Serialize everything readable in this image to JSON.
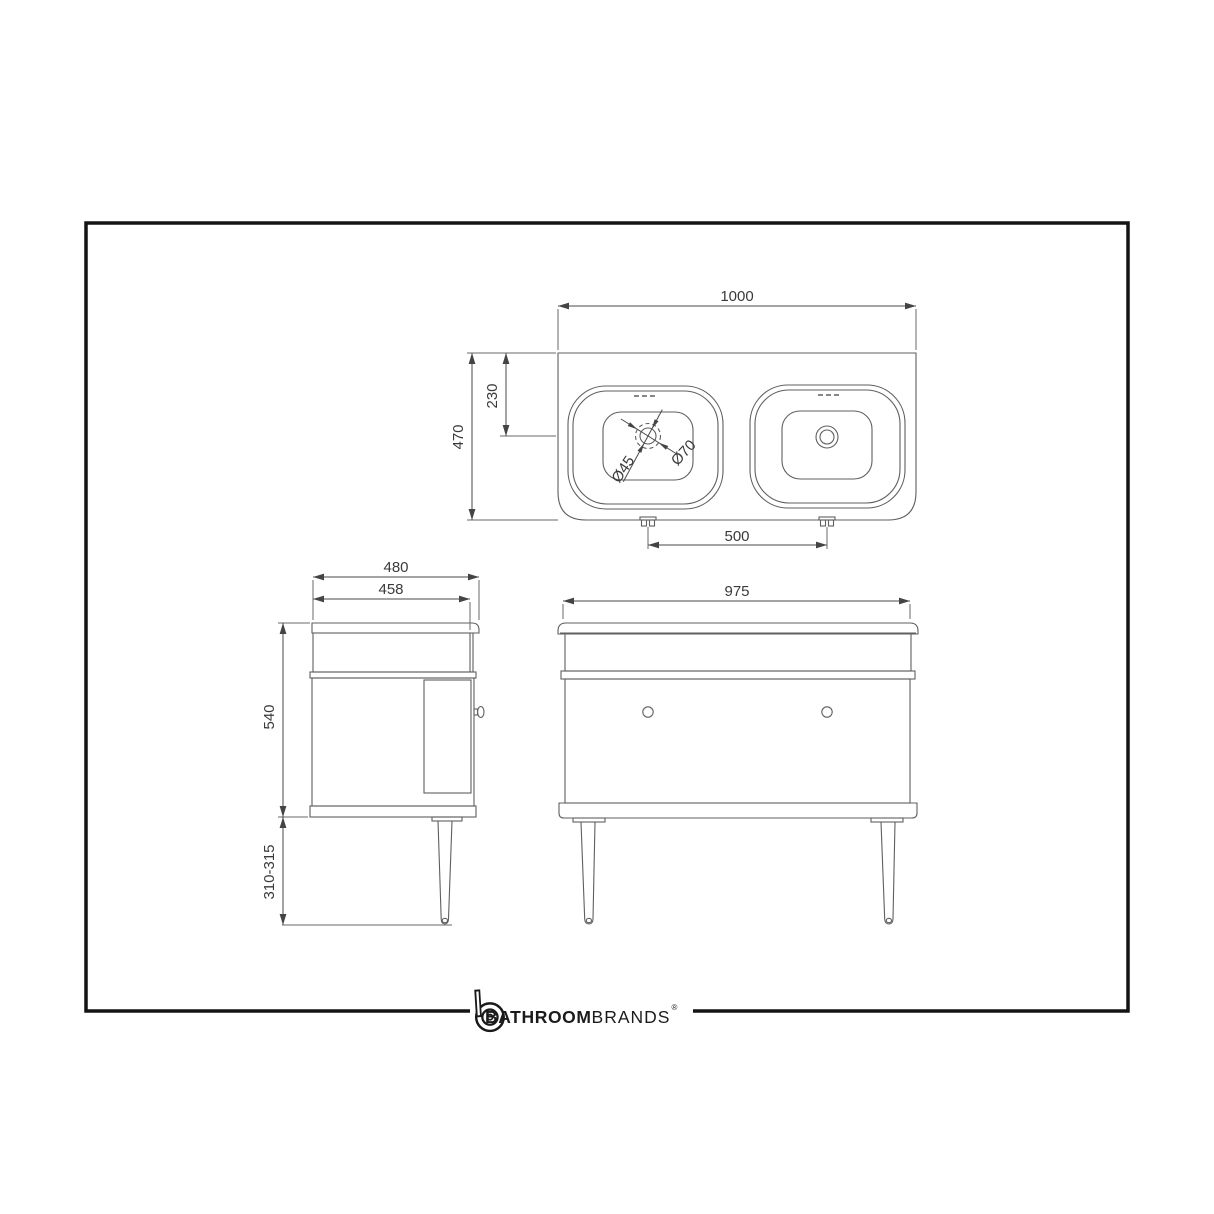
{
  "page": {
    "background": "#ffffff",
    "border_color": "#141414",
    "line_color": "#5f5f5f"
  },
  "views": {
    "top": {
      "title": "basin-plan-view",
      "dim_width": "1000",
      "dim_depth": "470",
      "dim_drain_setback": "230",
      "dim_waste_small": "Ø45",
      "dim_waste_large": "Ø70",
      "dim_fixing_centres": "500"
    },
    "side": {
      "title": "side-elevation",
      "dim_depth_overall": "480",
      "dim_depth_cabinet": "458",
      "dim_height_cabinet": "540",
      "dim_leg_height": "310-315"
    },
    "front": {
      "title": "front-elevation",
      "dim_width_cabinet": "975"
    }
  },
  "branding": {
    "name_bold": "BATHROOM",
    "name_light": "BRANDS",
    "registered_mark": "®"
  }
}
